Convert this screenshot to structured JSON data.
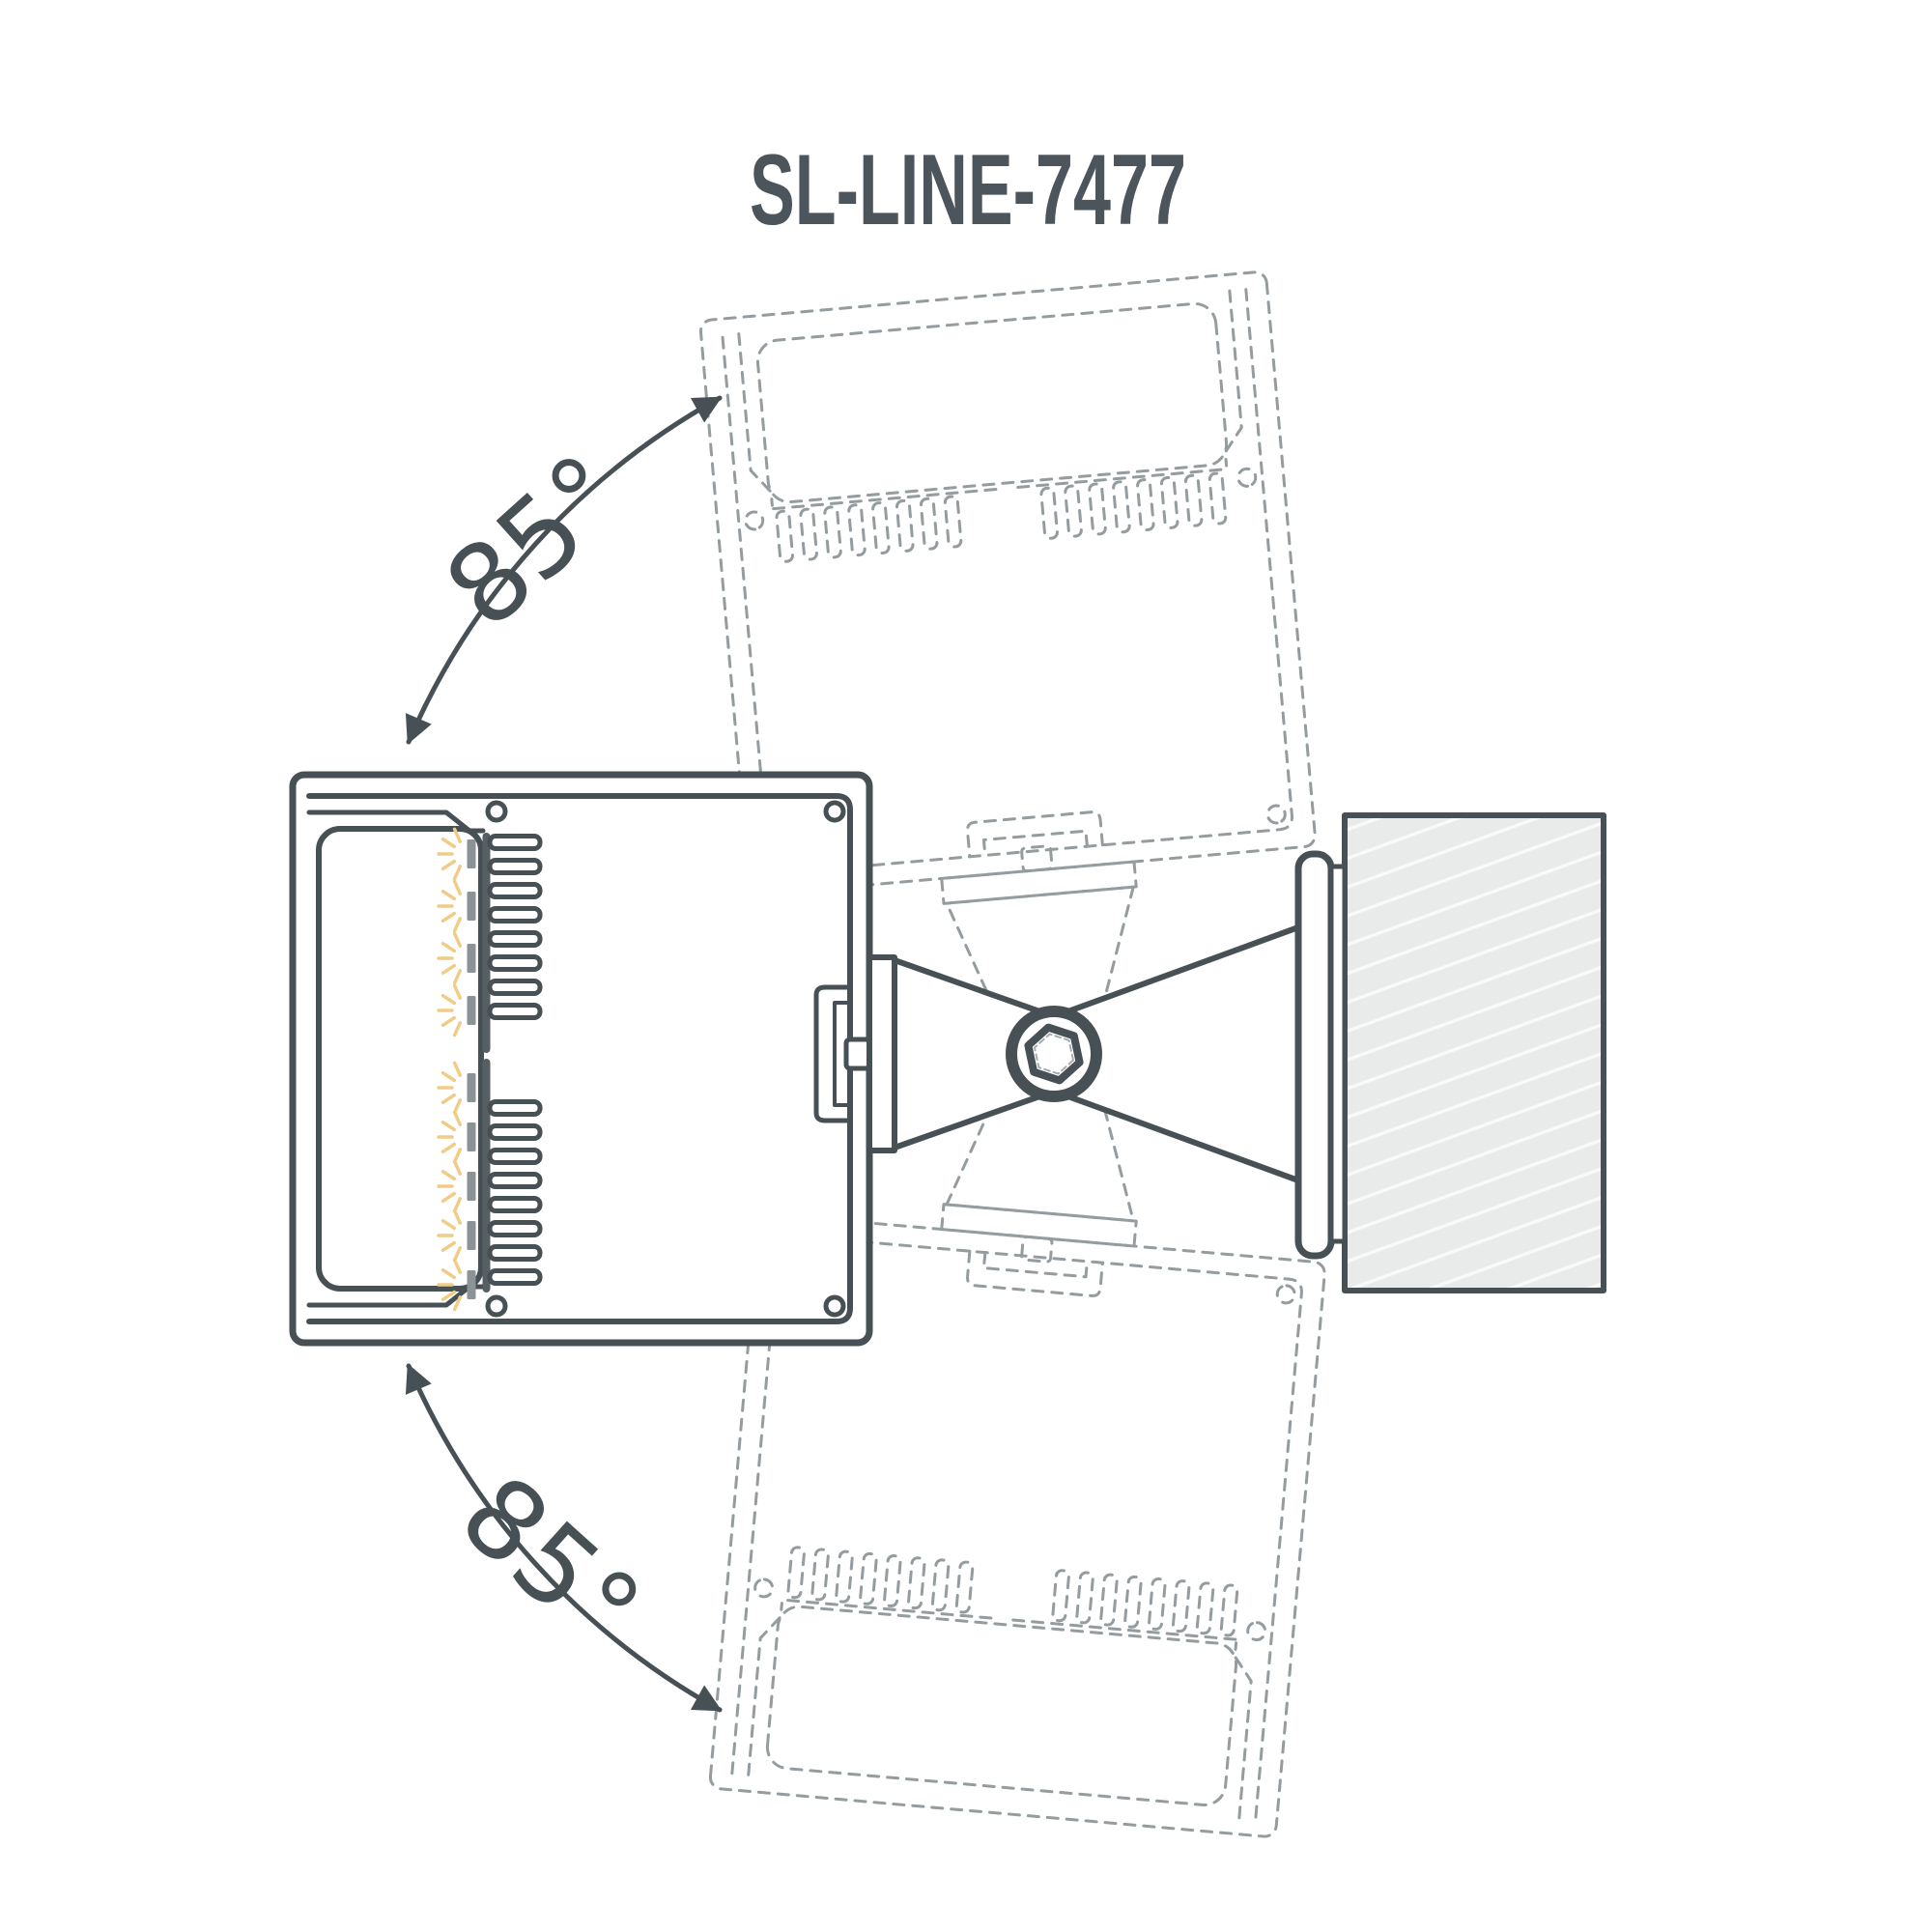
{
  "title": "SL-LINE-7477",
  "angles": {
    "top": {
      "label": "85°",
      "value_degrees": 85,
      "direction": "upward tilt"
    },
    "bottom": {
      "label": "85°",
      "value_degrees": 85,
      "direction": "downward tilt"
    }
  },
  "diagram": {
    "type": "luminaire tilt-range installation diagram",
    "subject": "wall-mounted adjustable linear LED luminaire cross-section",
    "solid_view": "luminaire pointing left, fixed to wall block via pivot bracket",
    "ghost_views": [
      "profile rotated 85° up (dashed)",
      "profile rotated 85° down (dashed)"
    ],
    "icons": [
      "hex-socket-screw-icon",
      "led-ray-icon",
      "rotation-arrow-icon"
    ]
  },
  "colors": {
    "ink": "#475054",
    "text": "#4c555b",
    "ghost_dash": "#949c9f",
    "wall_fill": "#e9eaea",
    "wall_hatch": "#f8f9f9",
    "led_ray": "#f1cc86",
    "led_chip": "#8b9396",
    "background": "#ffffff"
  }
}
